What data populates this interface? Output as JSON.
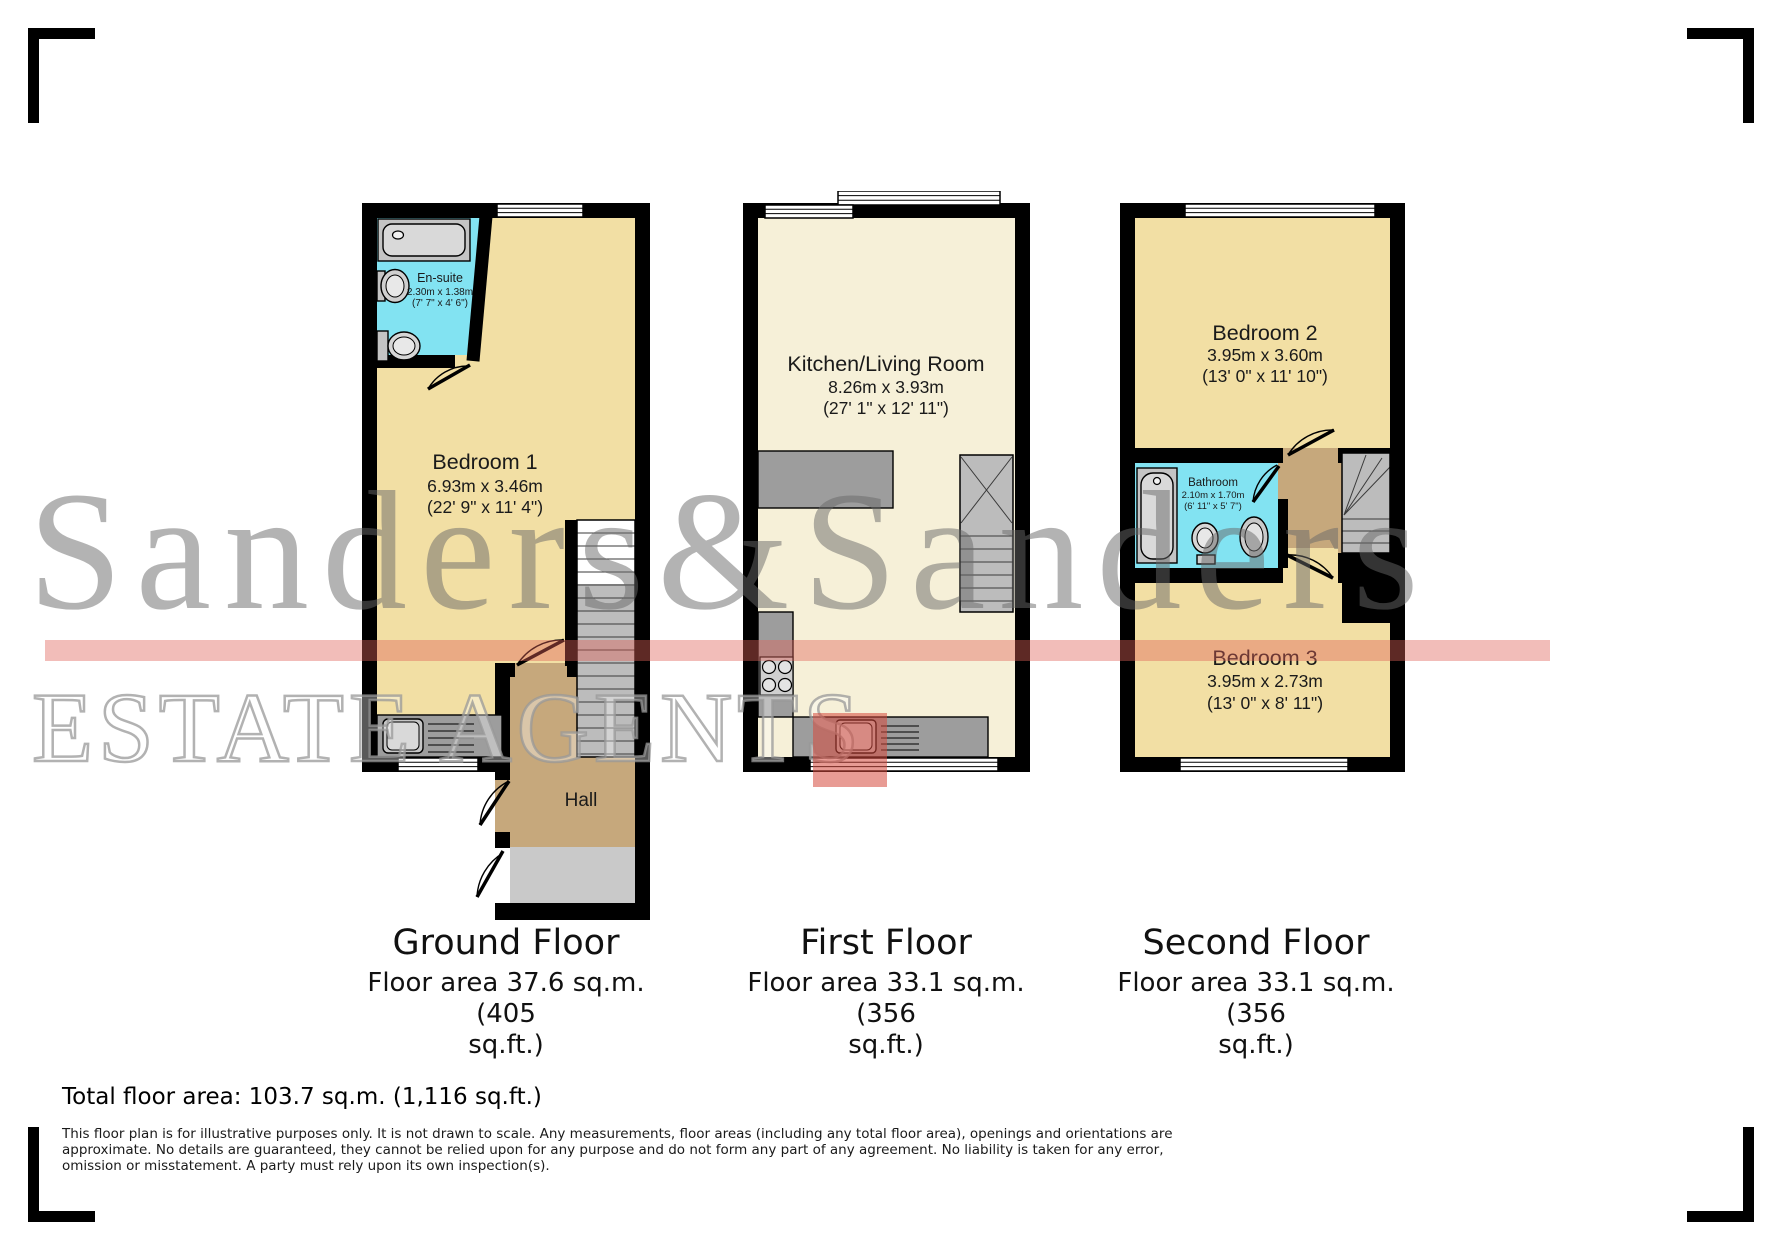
{
  "watermark": {
    "name": "Sanders&Sanders",
    "tagline": "ESTATE AGENTS",
    "brand_red": "#d6483c",
    "text_gray": "#686868"
  },
  "floors": {
    "ground": {
      "title": "Ground Floor",
      "area_line1": "Floor area 37.6 sq.m. (405",
      "area_line2": "sq.ft.)",
      "rooms": {
        "ensuite": {
          "name": "En-suite",
          "metric": "2.30m x 1.38m",
          "imperial": "(7' 7\" x 4' 6\")"
        },
        "bedroom1": {
          "name": "Bedroom 1",
          "metric": "6.93m x 3.46m",
          "imperial": "(22' 9\" x 11' 4\")"
        },
        "hall": {
          "name": "Hall"
        }
      }
    },
    "first": {
      "title": "First Floor",
      "area_line1": "Floor area 33.1 sq.m. (356",
      "area_line2": "sq.ft.)",
      "rooms": {
        "kitchen": {
          "name": "Kitchen/Living Room",
          "metric": "8.26m x 3.93m",
          "imperial": "(27' 1\" x 12' 11\")"
        }
      }
    },
    "second": {
      "title": "Second Floor",
      "area_line1": "Floor area 33.1 sq.m. (356",
      "area_line2": "sq.ft.)",
      "rooms": {
        "bedroom2": {
          "name": "Bedroom 2",
          "metric": "3.95m x 3.60m",
          "imperial": "(13' 0\" x 11' 10\")"
        },
        "bathroom": {
          "name": "Bathroom",
          "metric": "2.10m x 1.70m",
          "imperial": "(6' 11\" x 5' 7\")"
        },
        "bedroom3": {
          "name": "Bedroom 3",
          "metric": "3.95m x 2.73m",
          "imperial": "(13' 0\" x 8' 11\")"
        }
      }
    }
  },
  "totals": {
    "total_area": "Total floor area: 103.7 sq.m. (1,116 sq.ft.)"
  },
  "disclaimer_lines": [
    "This floor plan is for illustrative purposes only. It is not drawn to scale. Any measurements, floor areas (including any total floor area), openings and orientations are",
    "approximate. No details are guaranteed, they cannot be relied upon for any purpose and do not form any part of any agreement. No liability is taken for any error,",
    "omission or misstatement. A party must rely upon its own inspection(s)."
  ],
  "colors": {
    "wall_black": "#000000",
    "room_yellow": "#f2dfa4",
    "room_cream": "#f6f0d8",
    "wet_cyan": "#82e3f2",
    "hall_brown": "#c6a87c",
    "porch_gray": "#c9c9c9",
    "counter_gray": "#9d9d9d",
    "stair_gray": "#bcbcbc",
    "fixture_gray": "#d9d9d9",
    "white": "#ffffff"
  }
}
